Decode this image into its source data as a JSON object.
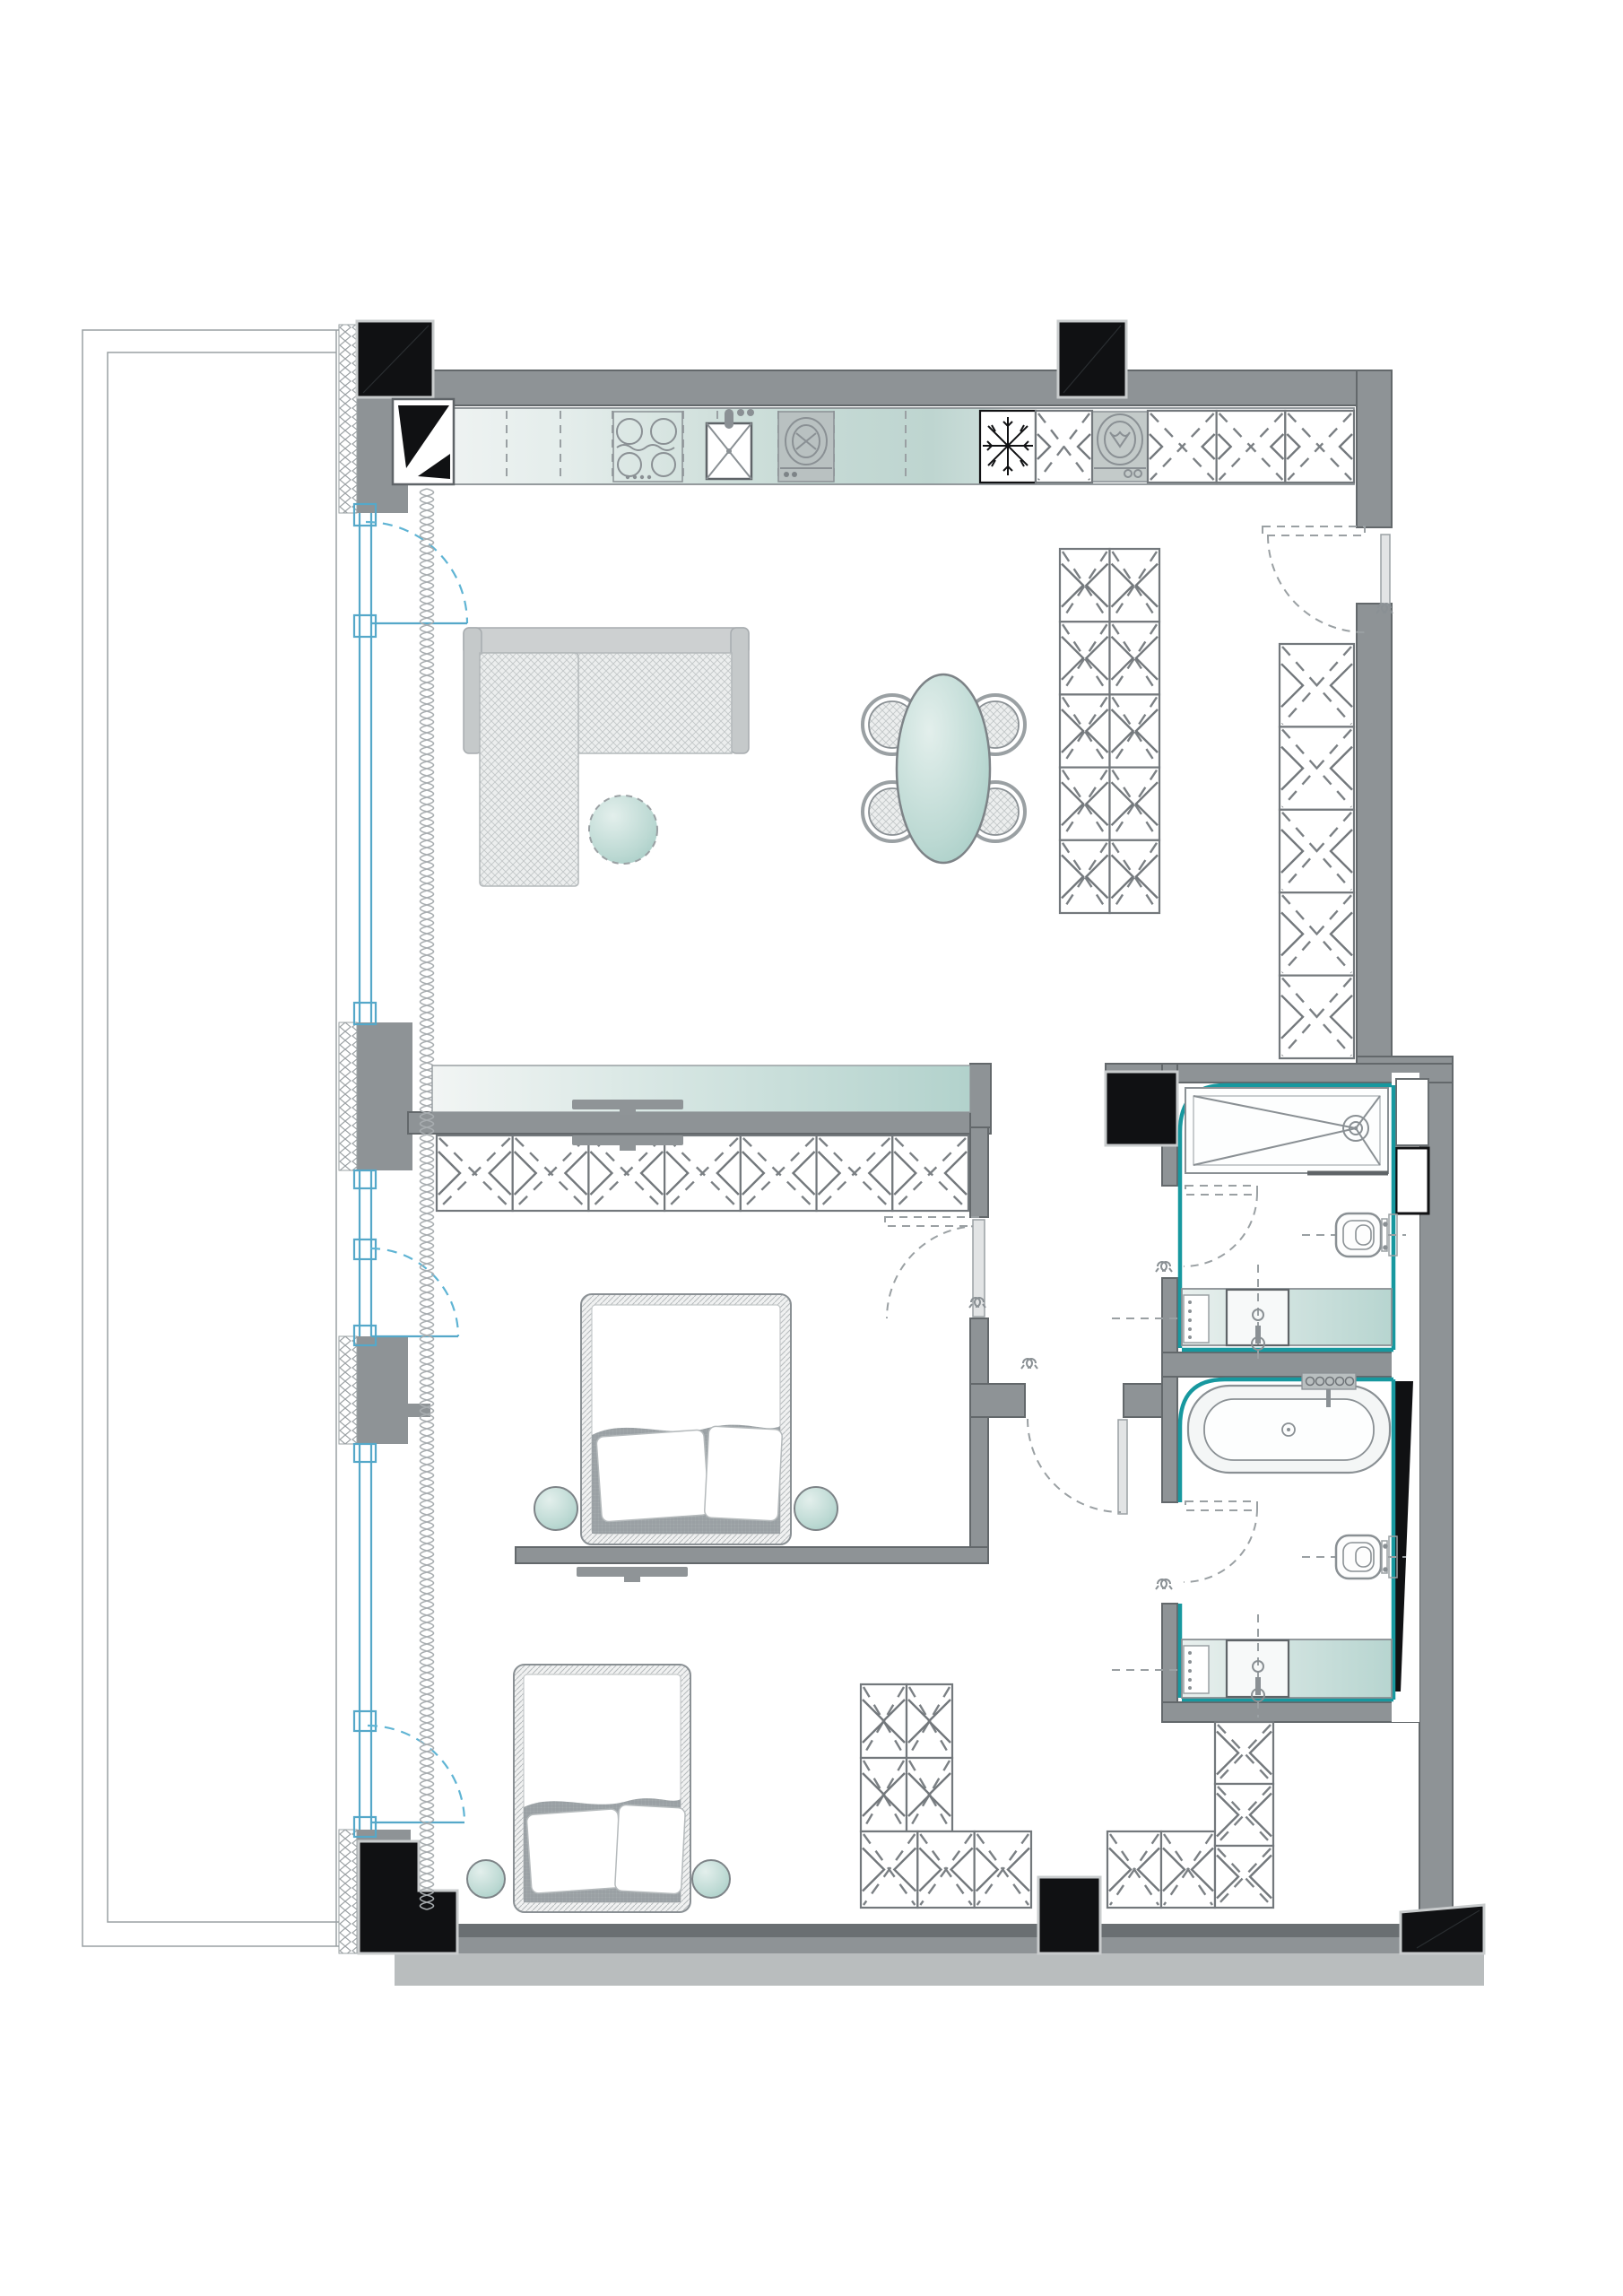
{
  "title": "apartment-floor-plan",
  "palette": {
    "white": "#ffffff",
    "wall": "#8e9396",
    "wall_dark": "#63686b",
    "wall_light": "#b9bdbe",
    "black": "#101113",
    "teal": "#17989f",
    "teal_surface": "#b7d5d0",
    "teal_soft": "#dcebe8",
    "blue": "#55a8c9",
    "blue_dash": "#5fb4d4",
    "furn": "#8a9094",
    "furn_light": "#9aa0a3",
    "curtain": "#a8adb0",
    "blanket": "#9aa0a5"
  },
  "rooms": [
    {
      "name": "living-kitchen",
      "furniture": [
        "kitchen-counter",
        "corner-cabinet",
        "cooktop",
        "sink",
        "dishwasher",
        "fridge",
        "washing-machine",
        "corner-sofa",
        "coffee-table",
        "dining-table",
        "dining-chairs",
        "tv-console",
        "tv"
      ]
    },
    {
      "name": "hallway",
      "furniture": [
        "wardrobe"
      ]
    },
    {
      "name": "bedroom-1",
      "furniture": [
        "double-bed",
        "nightstand",
        "nightstand",
        "wardrobe",
        "tv"
      ]
    },
    {
      "name": "bedroom-2",
      "furniture": [
        "double-bed",
        "nightstand",
        "nightstand",
        "wardrobe-l-shape",
        "tv"
      ]
    },
    {
      "name": "shower-room",
      "furniture": [
        "walk-in-shower",
        "wall-hung-toilet",
        "vanity-sink"
      ]
    },
    {
      "name": "bathroom",
      "furniture": [
        "bathtub",
        "wall-hung-toilet",
        "vanity-sink"
      ]
    },
    {
      "name": "balcony",
      "furniture": []
    }
  ],
  "wardrobe_units": {
    "dining": {
      "rows": 5,
      "cols": 2
    },
    "hall": {
      "rows": 5,
      "cols": 1
    },
    "bedroom1": {
      "rows": 1,
      "cols": 7
    },
    "bd2_left": {
      "rows": 2,
      "cols": 2
    },
    "bd2_bottom_a": {
      "rows": 1,
      "cols": 3
    },
    "bd2_bottom_b": {
      "rows": 1,
      "cols": 2
    },
    "bd2_corner": {
      "rows": 3,
      "cols": 1
    },
    "kitchen_a": {
      "rows": 1,
      "cols": 1
    },
    "kitchen_b": {
      "rows": 1,
      "cols": 3
    }
  },
  "counts": {
    "balcony_doors": 3,
    "interior_doors": 5,
    "entrance_doors": 1,
    "dining_chairs": 4,
    "beds": 2,
    "toilets": 2,
    "sinks": 3,
    "tv_screens": 3
  }
}
